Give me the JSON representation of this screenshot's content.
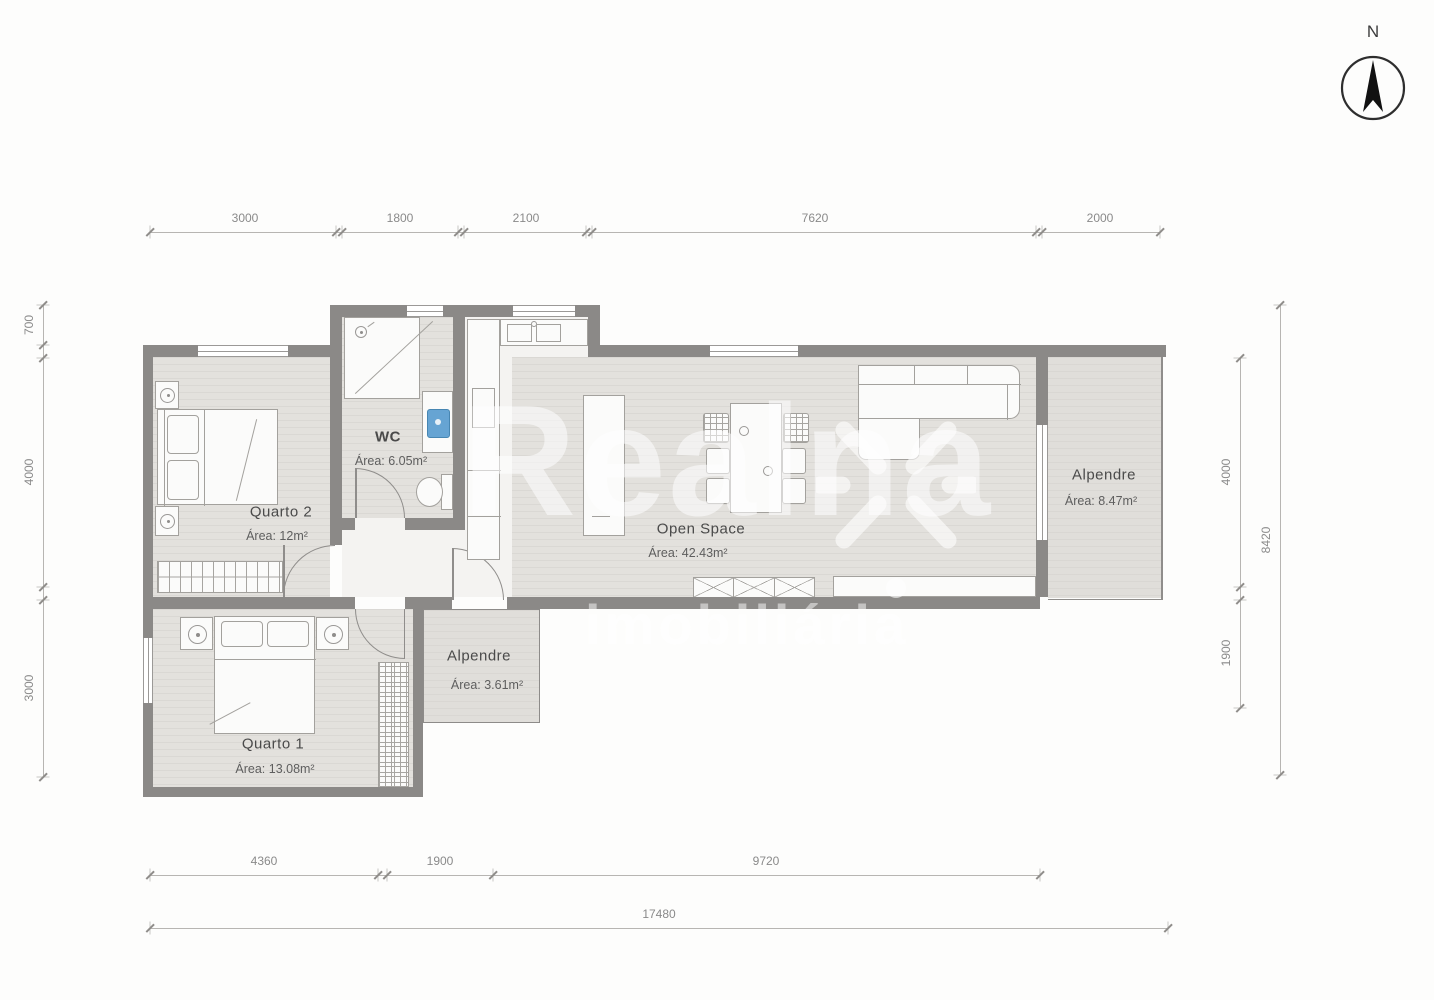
{
  "compass": {
    "label": "N"
  },
  "watermark": {
    "brand": "Realna",
    "subtitle": "imobiliária"
  },
  "rooms": [
    {
      "name": "Quarto 2",
      "area": "Área: 12m²"
    },
    {
      "name": "WC",
      "area": "Área: 6.05m²"
    },
    {
      "name": "Open Space",
      "area": "Área: 42.43m²"
    },
    {
      "name": "Alpendre",
      "area": "Área: 8.47m²"
    },
    {
      "name": "Alpendre",
      "area": "Área: 3.61m²"
    },
    {
      "name": "Quarto 1",
      "area": "Área: 13.08m²"
    }
  ],
  "dimensions": {
    "top": [
      "3000",
      "1800",
      "2100",
      "7620",
      "2000"
    ],
    "left": [
      "700",
      "4000",
      "3000"
    ],
    "right": [
      "4000",
      "1900",
      "8420"
    ],
    "bottom": [
      "4360",
      "1900",
      "9720",
      "17480"
    ]
  }
}
